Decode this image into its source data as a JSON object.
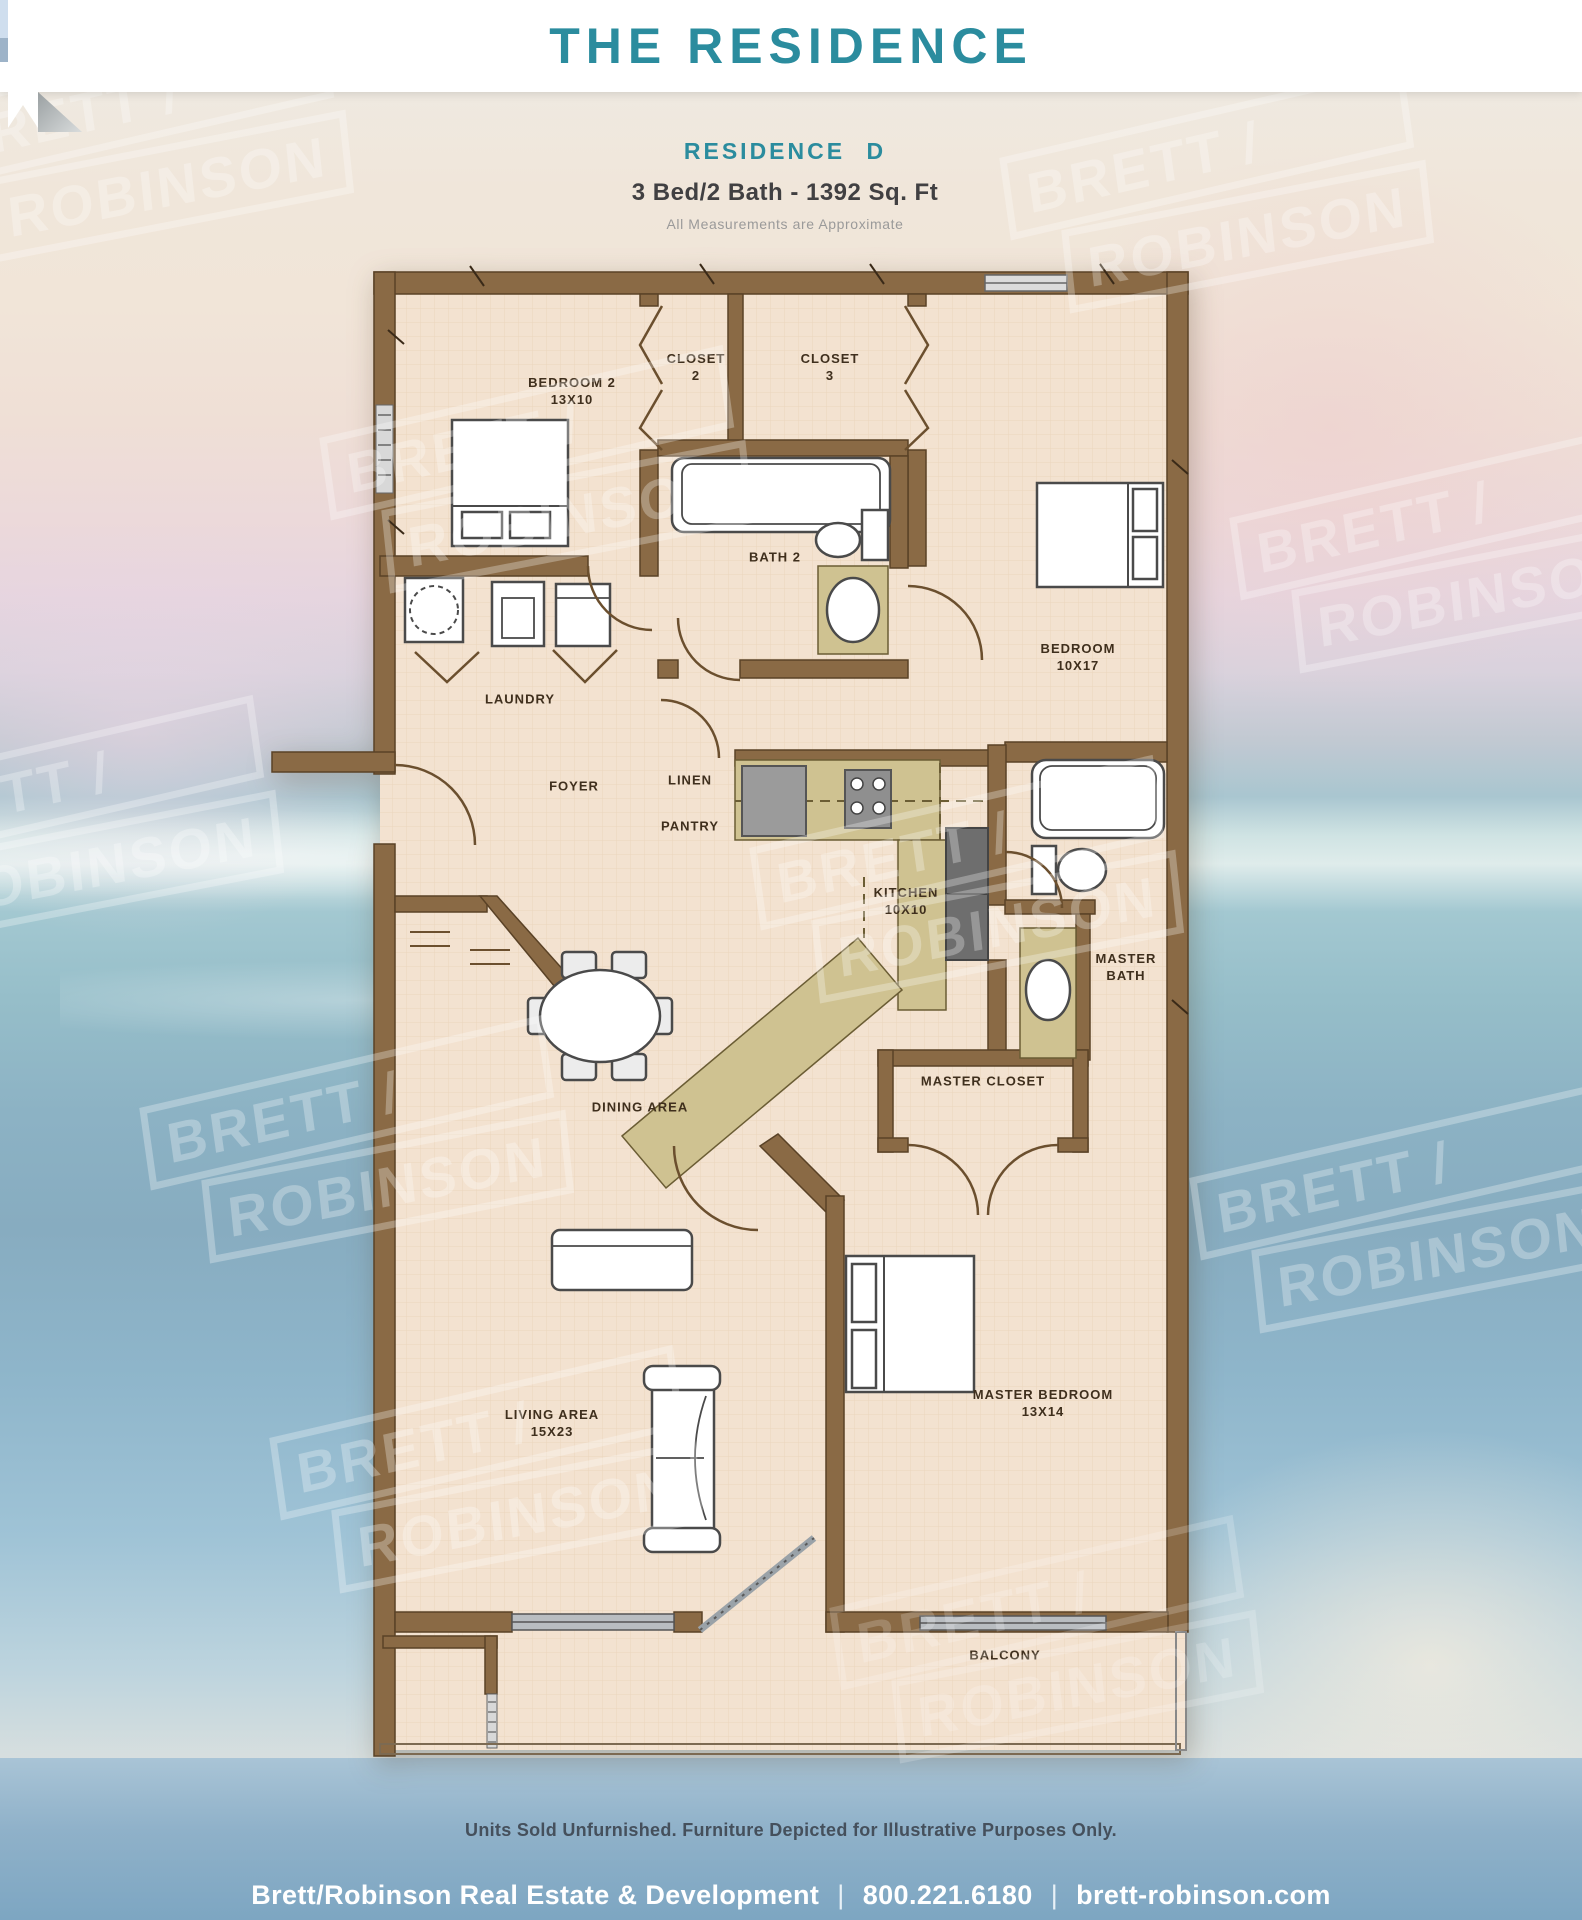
{
  "header": {
    "title": "THE RESIDENCE"
  },
  "plan_header": {
    "residence": "RESIDENCE D",
    "specs": "3 Bed/2 Bath - 1392 Sq. Ft",
    "note": "All Measurements are Approximate"
  },
  "watermark": {
    "line1": "BRETT /",
    "line2": "ROBINSON"
  },
  "rooms": {
    "bedroom2": {
      "name": "BEDROOM 2",
      "dims": "13X10"
    },
    "closet2": {
      "name": "CLOSET",
      "number": "2"
    },
    "closet3": {
      "name": "CLOSET",
      "number": "3"
    },
    "bath2": {
      "name": "BATH 2"
    },
    "bedroom": {
      "name": "BEDROOM",
      "dims": "10X17"
    },
    "laundry": {
      "name": "LAUNDRY"
    },
    "foyer": {
      "name": "FOYER"
    },
    "linen": {
      "name": "LINEN"
    },
    "pantry": {
      "name": "PANTRY"
    },
    "kitchen": {
      "name": "KITCHEN",
      "dims": "10X10"
    },
    "master_bath": {
      "line1": "MASTER",
      "line2": "BATH"
    },
    "master_closet": {
      "name": "MASTER CLOSET"
    },
    "dining": {
      "name": "DINING AREA"
    },
    "living": {
      "name": "LIVING AREA",
      "dims": "15X23"
    },
    "master_bedroom": {
      "name": "MASTER BEDROOM",
      "dims": "13X14"
    },
    "balcony": {
      "name": "BALCONY"
    }
  },
  "footer": {
    "disclaimer": "Units Sold Unfurnished. Furniture Depicted for Illustrative Purposes Only.",
    "company": "Brett/Robinson Real Estate & Development",
    "phone": "800.221.6180",
    "website": "brett-robinson.com",
    "separator": "|"
  },
  "colors": {
    "teal": "#2b8c9e",
    "wall_brown": "#8a6a45",
    "floor_tan": "#f3e2d0",
    "counter_olive": "#cfc291",
    "footer_blue": "#8fb1c9"
  }
}
